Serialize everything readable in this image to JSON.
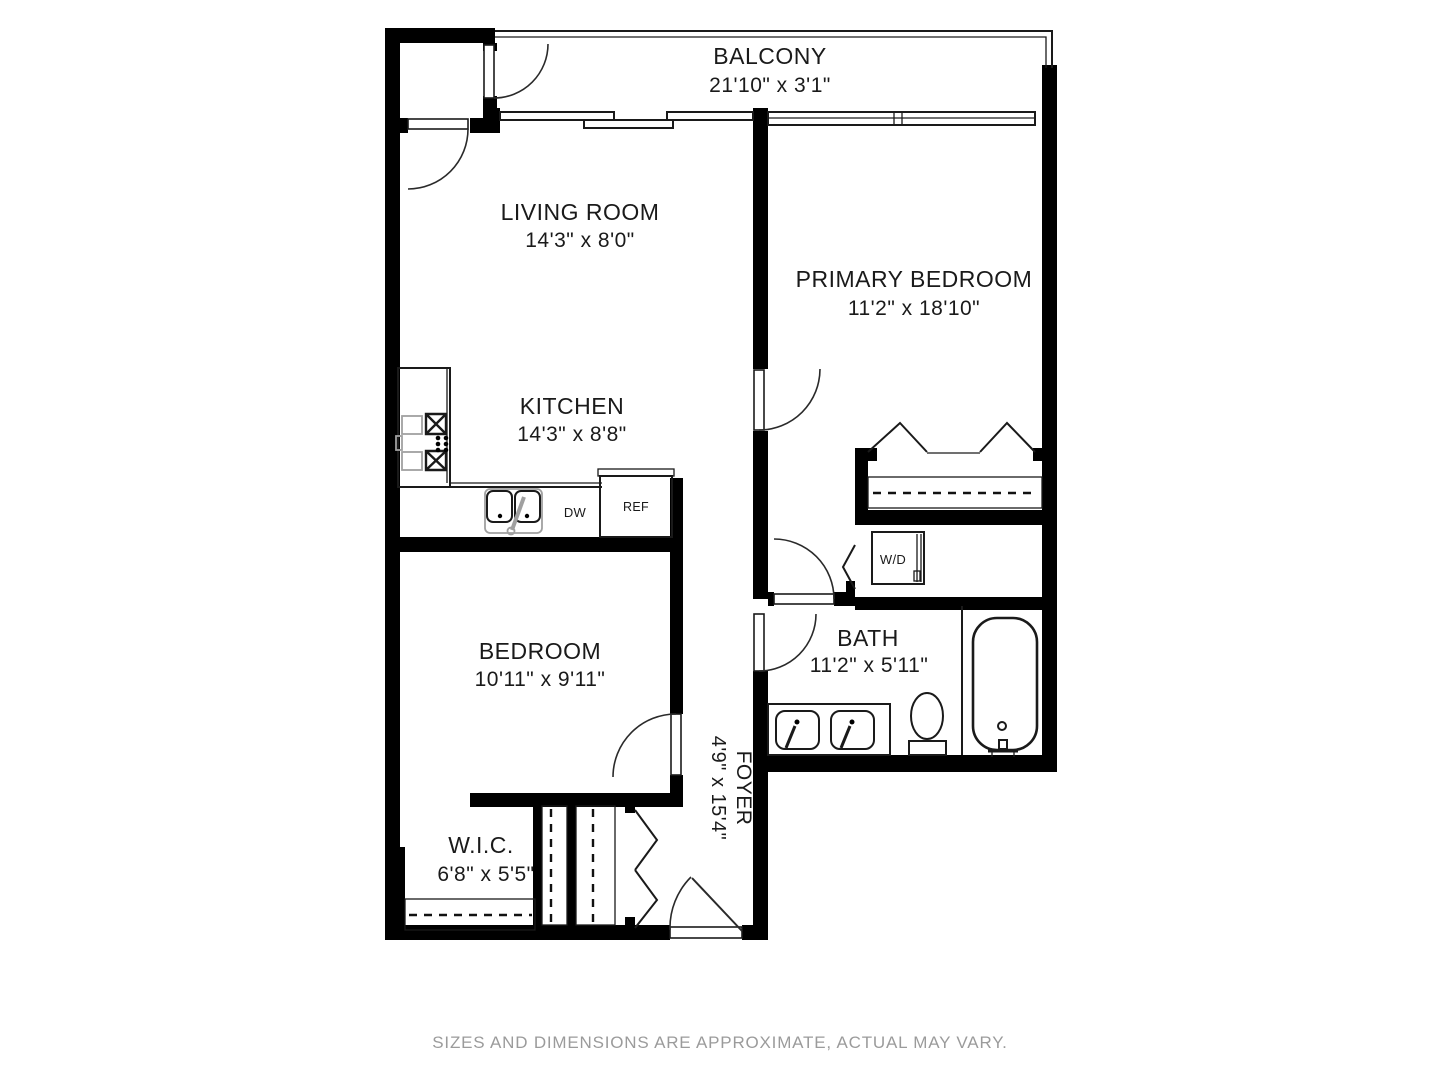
{
  "rooms": {
    "balcony": {
      "name": "BALCONY",
      "dims": "21'10\" x 3'1\""
    },
    "living_room": {
      "name": "LIVING ROOM",
      "dims": "14'3\" x 8'0\""
    },
    "primary_bedroom": {
      "name": "PRIMARY BEDROOM",
      "dims": "11'2\" x 18'10\""
    },
    "kitchen": {
      "name": "KITCHEN",
      "dims": "14'3\" x 8'8\""
    },
    "bedroom": {
      "name": "BEDROOM",
      "dims": "10'11\" x 9'11\""
    },
    "bath": {
      "name": "BATH",
      "dims": "11'2\" x 5'11\""
    },
    "wic": {
      "name": "W.I.C.",
      "dims": "6'8\" x 5'5\""
    },
    "foyer": {
      "name": "FOYER",
      "dims": "4'9\" x 15'4\""
    }
  },
  "appliances": {
    "washer_dryer": "W/D",
    "refrigerator": "REF",
    "dishwasher": "DW"
  },
  "footer": {
    "disclaimer": "SIZES AND DIMENSIONS ARE APPROXIMATE, ACTUAL MAY VARY."
  },
  "colors": {
    "wall": "#000000",
    "line": "#1a1a1a",
    "fixture_gray": "#a0a0a0",
    "footer_text": "#9b9b9b"
  }
}
